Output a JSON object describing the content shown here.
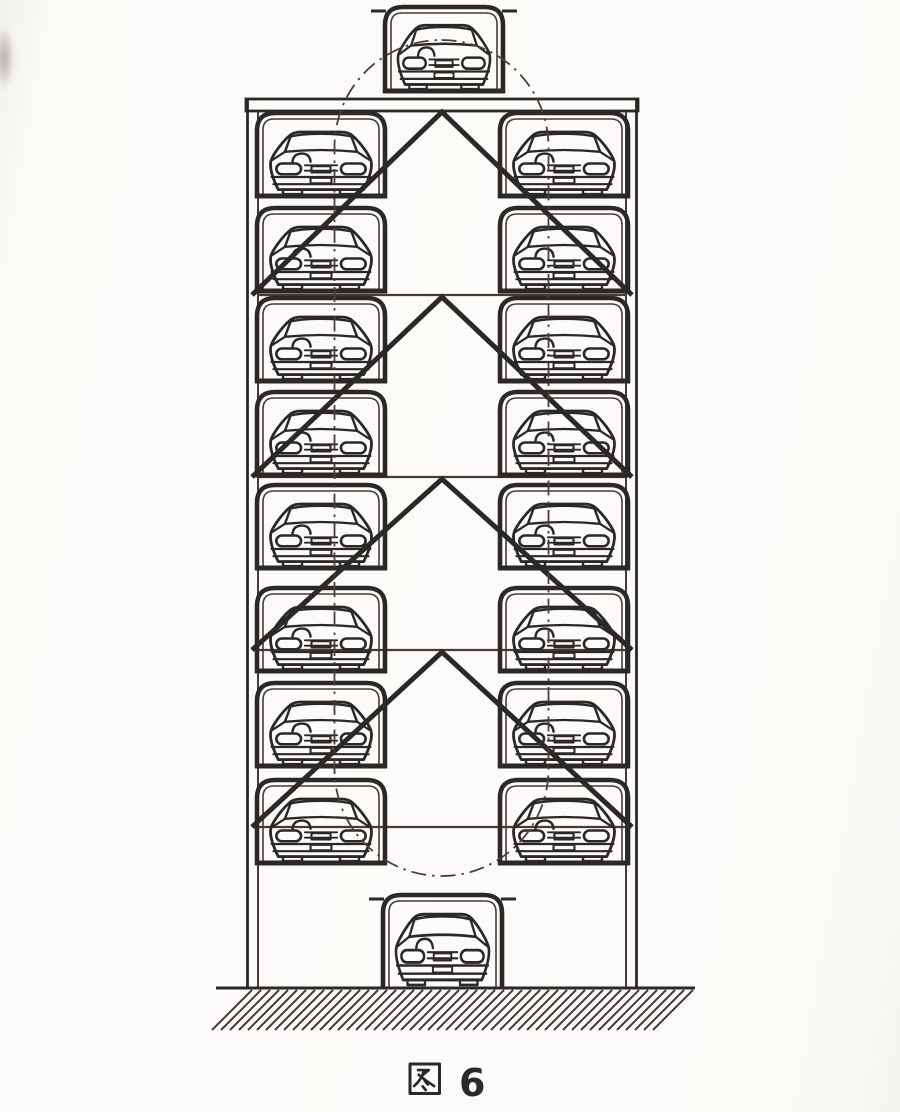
{
  "figure": {
    "caption": "图 6",
    "caption_glyph": "图",
    "caption_number": "6"
  },
  "palette": {
    "ink": "#2b2926",
    "ink_soft": "#413d38",
    "paper": "#fbfaf7",
    "path_line": "#45413c"
  },
  "structure": {
    "levels": 8,
    "car_columns": 2,
    "cars_left": 8,
    "cars_right": 8,
    "car_on_top": 1,
    "car_at_ground": 1,
    "total_cars": 18,
    "brace_chevrons": 4,
    "crossbeams": 4
  }
}
